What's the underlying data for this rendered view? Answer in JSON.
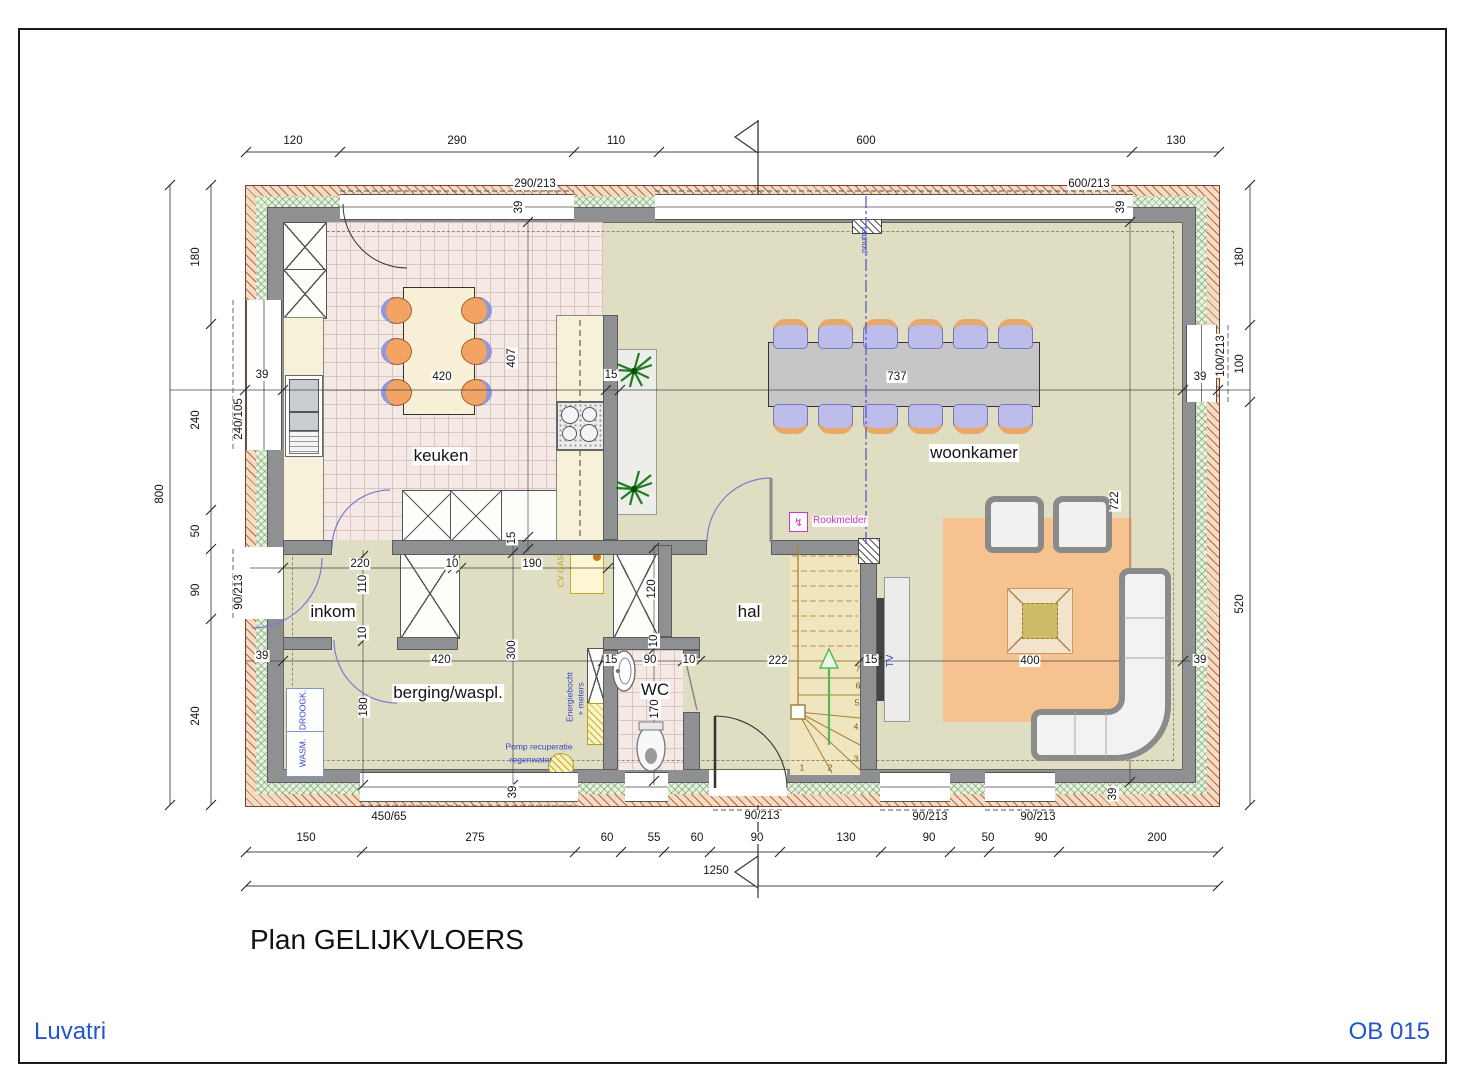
{
  "title_block": {
    "plan_title": "Plan GELIJKVLOERS",
    "company": "Luvatri",
    "sheet_no": "OB 015"
  },
  "colors": {
    "floor": "#dfdec2",
    "kitchen_tile": "#f5e9e5",
    "wall_gray": "#8e9092",
    "brick_hatch": "#be4b37",
    "insulation_green": "#5a965a",
    "rug_orange": "#f6c28f",
    "annotation_blue": "#3344cc",
    "annotation_magenta": "#cc33cc",
    "annotation_yellow": "#c2a416",
    "brand_blue": "#2255cc"
  },
  "labels": {
    "dimensions": [
      {
        "t": "120",
        "x": 293,
        "y": 141
      },
      {
        "t": "290",
        "x": 457,
        "y": 141
      },
      {
        "t": "110",
        "x": 616,
        "y": 141
      },
      {
        "t": "600",
        "x": 866,
        "y": 141
      },
      {
        "t": "130",
        "x": 1176,
        "y": 141
      },
      {
        "t": "290/213",
        "x": 535,
        "y": 184
      },
      {
        "t": "600/213",
        "x": 1089,
        "y": 184
      },
      {
        "t": "39",
        "x": 519,
        "y": 207,
        "v": 1
      },
      {
        "t": "39",
        "x": 1121,
        "y": 207,
        "v": 1
      },
      {
        "t": "800",
        "x": 160,
        "y": 494,
        "v": 1
      },
      {
        "t": "180",
        "x": 196,
        "y": 257,
        "v": 1
      },
      {
        "t": "240",
        "x": 196,
        "y": 420,
        "v": 1
      },
      {
        "t": "50",
        "x": 196,
        "y": 531,
        "v": 1
      },
      {
        "t": "90",
        "x": 196,
        "y": 590,
        "v": 1
      },
      {
        "t": "240",
        "x": 196,
        "y": 716,
        "v": 1
      },
      {
        "t": "240/105",
        "x": 239,
        "y": 419,
        "v": 1
      },
      {
        "t": "90/213",
        "x": 239,
        "y": 592,
        "v": 1
      },
      {
        "t": "39",
        "x": 262,
        "y": 375
      },
      {
        "t": "39",
        "x": 262,
        "y": 656
      },
      {
        "t": "180",
        "x": 1240,
        "y": 257,
        "v": 1
      },
      {
        "t": "100",
        "x": 1240,
        "y": 364,
        "v": 1
      },
      {
        "t": "520",
        "x": 1240,
        "y": 604,
        "v": 1
      },
      {
        "t": "100/213",
        "x": 1221,
        "y": 356,
        "v": 1
      },
      {
        "t": "39",
        "x": 1200,
        "y": 377
      },
      {
        "t": "39",
        "x": 1200,
        "y": 660
      },
      {
        "t": "450/65",
        "x": 389,
        "y": 817
      },
      {
        "t": "90/213",
        "x": 762,
        "y": 816
      },
      {
        "t": "90/213",
        "x": 930,
        "y": 817
      },
      {
        "t": "90/213",
        "x": 1038,
        "y": 817
      },
      {
        "t": "39",
        "x": 513,
        "y": 792,
        "v": 1
      },
      {
        "t": "39",
        "x": 1113,
        "y": 794,
        "v": 1
      },
      {
        "t": "150",
        "x": 306,
        "y": 838
      },
      {
        "t": "275",
        "x": 475,
        "y": 838
      },
      {
        "t": "60",
        "x": 607,
        "y": 838
      },
      {
        "t": "55",
        "x": 654,
        "y": 838
      },
      {
        "t": "60",
        "x": 697,
        "y": 838
      },
      {
        "t": "90",
        "x": 757,
        "y": 838
      },
      {
        "t": "130",
        "x": 846,
        "y": 838
      },
      {
        "t": "90",
        "x": 929,
        "y": 838
      },
      {
        "t": "50",
        "x": 988,
        "y": 838
      },
      {
        "t": "90",
        "x": 1041,
        "y": 838
      },
      {
        "t": "200",
        "x": 1157,
        "y": 838
      },
      {
        "t": "1250",
        "x": 716,
        "y": 871
      },
      {
        "t": "420",
        "x": 442,
        "y": 377
      },
      {
        "t": "407",
        "x": 512,
        "y": 358,
        "v": 1
      },
      {
        "t": "15",
        "x": 611,
        "y": 375
      },
      {
        "t": "15",
        "x": 512,
        "y": 538,
        "v": 1
      },
      {
        "t": "737",
        "x": 897,
        "y": 377
      },
      {
        "t": "722",
        "x": 1115,
        "y": 501,
        "v": 1
      },
      {
        "t": "400",
        "x": 1030,
        "y": 661
      },
      {
        "t": "15",
        "x": 871,
        "y": 660
      },
      {
        "t": "220",
        "x": 360,
        "y": 564
      },
      {
        "t": "110",
        "x": 363,
        "y": 584,
        "v": 1
      },
      {
        "t": "10",
        "x": 452,
        "y": 564
      },
      {
        "t": "10",
        "x": 363,
        "y": 633,
        "v": 1
      },
      {
        "t": "420",
        "x": 441,
        "y": 660
      },
      {
        "t": "300",
        "x": 512,
        "y": 650,
        "v": 1
      },
      {
        "t": "180",
        "x": 364,
        "y": 707,
        "v": 1
      },
      {
        "t": "190",
        "x": 532,
        "y": 564
      },
      {
        "t": "15",
        "x": 611,
        "y": 660
      },
      {
        "t": "90",
        "x": 650,
        "y": 660
      },
      {
        "t": "10",
        "x": 689,
        "y": 660
      },
      {
        "t": "170",
        "x": 655,
        "y": 709,
        "v": 1
      },
      {
        "t": "10",
        "x": 654,
        "y": 641,
        "v": 1
      },
      {
        "t": "120",
        "x": 652,
        "y": 589,
        "v": 1
      },
      {
        "t": "222",
        "x": 778,
        "y": 661
      }
    ],
    "rooms": [
      {
        "t": "keuken",
        "x": 441,
        "y": 456
      },
      {
        "t": "woonkamer",
        "x": 974,
        "y": 453
      },
      {
        "t": "inkom",
        "x": 333,
        "y": 612
      },
      {
        "t": "berging/waspl.",
        "x": 448,
        "y": 693
      },
      {
        "t": "WC",
        "x": 655,
        "y": 690
      },
      {
        "t": "hal",
        "x": 749,
        "y": 612
      }
    ],
    "annotations": [
      {
        "t": "Rookmelder",
        "x": 840,
        "y": 521,
        "c": "magenta",
        "s": "ann"
      },
      {
        "t": "poutrel",
        "x": 864,
        "y": 240,
        "v": 1,
        "c": "blue",
        "s": "tiny nobg"
      },
      {
        "t": "TV",
        "x": 891,
        "y": 661,
        "v": 1,
        "c": "blue",
        "s": "ann nobg"
      },
      {
        "t": "CV GAS",
        "x": 561,
        "y": 571,
        "v": 1,
        "c": "yellow",
        "s": "tiny nobg"
      },
      {
        "t": "Energiebocht",
        "x": 570,
        "y": 697,
        "v": 1,
        "c": "blue",
        "s": "tiny nobg"
      },
      {
        "t": "+ meters",
        "x": 581,
        "y": 699,
        "v": 1,
        "c": "blue",
        "s": "tiny nobg"
      },
      {
        "t": "Pomp recuperatie",
        "x": 539,
        "y": 747,
        "c": "blue",
        "s": "tiny nobg"
      },
      {
        "t": "regenwater",
        "x": 531,
        "y": 760,
        "c": "blue",
        "s": "tiny nobg"
      },
      {
        "t": "DROOGK.",
        "x": 303,
        "y": 710,
        "v": 1,
        "c": "blue",
        "s": "tiny nobg"
      },
      {
        "t": "WASM.",
        "x": 303,
        "y": 753,
        "v": 1,
        "c": "blue",
        "s": "tiny nobg"
      }
    ],
    "stair_steps": [
      {
        "t": "7",
        "x": 858,
        "y": 669,
        "c": "brown",
        "s": "tiny nobg"
      },
      {
        "t": "6",
        "x": 858,
        "y": 686,
        "c": "brown",
        "s": "tiny nobg"
      },
      {
        "t": "5",
        "x": 857,
        "y": 703,
        "c": "brown",
        "s": "tiny nobg"
      },
      {
        "t": "4",
        "x": 856,
        "y": 727,
        "c": "brown",
        "s": "tiny nobg"
      },
      {
        "t": "3",
        "x": 856,
        "y": 759,
        "c": "brown",
        "s": "tiny nobg"
      },
      {
        "t": "2",
        "x": 830,
        "y": 768,
        "c": "brown",
        "s": "tiny nobg"
      },
      {
        "t": "1",
        "x": 802,
        "y": 768,
        "c": "brown",
        "s": "tiny nobg"
      }
    ],
    "icons": [
      {
        "t": "↯",
        "x": 798,
        "y": 521,
        "s": "rook"
      }
    ]
  }
}
